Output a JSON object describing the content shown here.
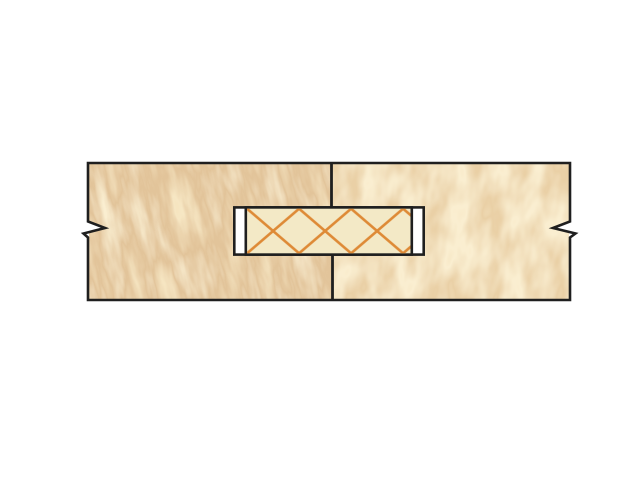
{
  "window": {
    "background_color": "#ffffff"
  },
  "diagram": {
    "colors": {
      "wood": "#eed096",
      "wood_shadow": "#d6ae6e",
      "wood_highlight": "#f8e8c0",
      "outline": "#1f1f1f",
      "tenon": "#f3e9c6",
      "hatch": "#de8a36",
      "slot_gap": "#ffffff"
    }
  }
}
